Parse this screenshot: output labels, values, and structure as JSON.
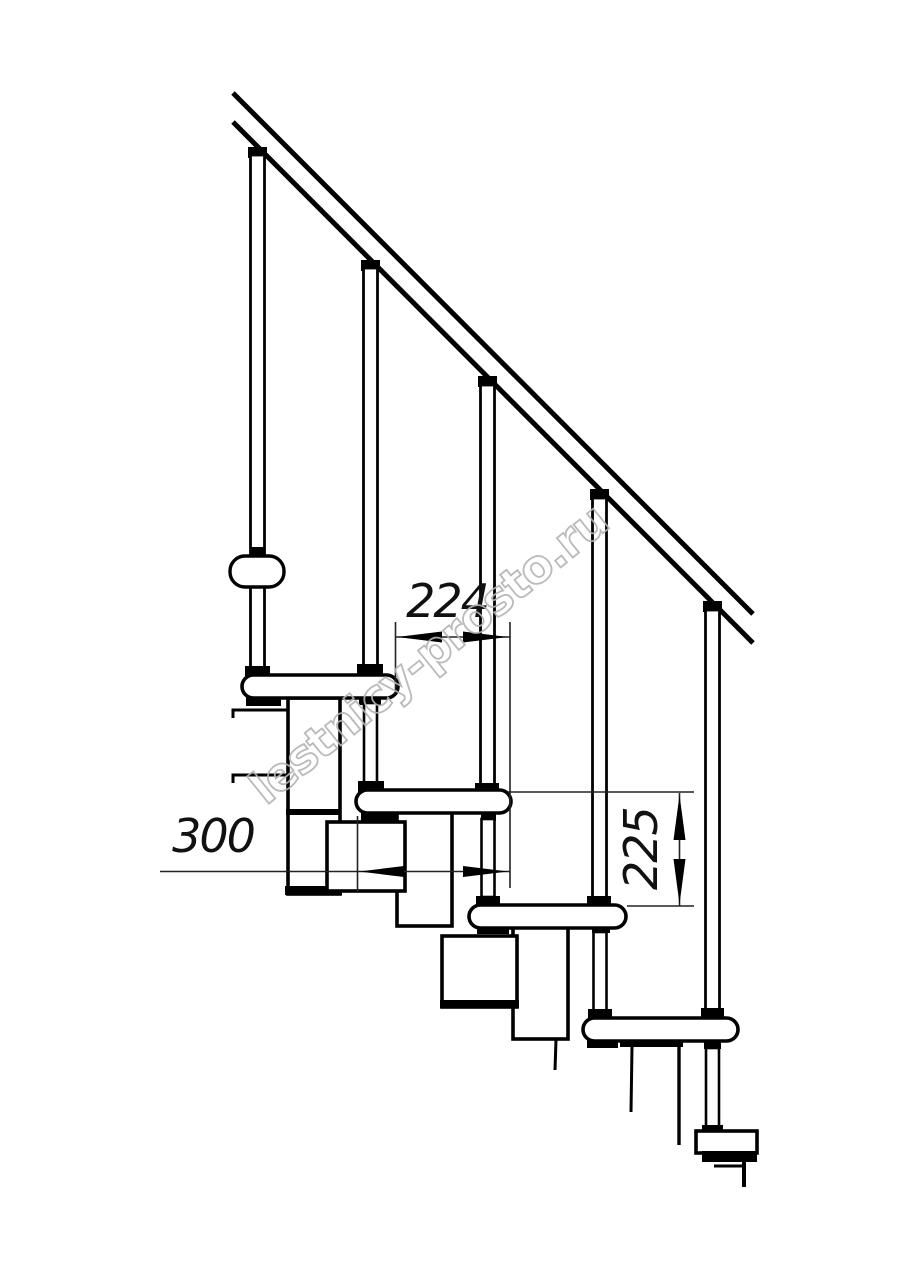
{
  "document": {
    "type": "staircase side-view technical drawing",
    "background_color": "#ffffff",
    "line_color": "#000000"
  },
  "watermark": {
    "text": "lestnicy-prosto.ru",
    "color": "#b3b3b3"
  },
  "dimensions": {
    "horizontal_224": {
      "value": "224"
    },
    "horizontal_300": {
      "value": "300"
    },
    "vertical_225": {
      "value": "225"
    }
  }
}
